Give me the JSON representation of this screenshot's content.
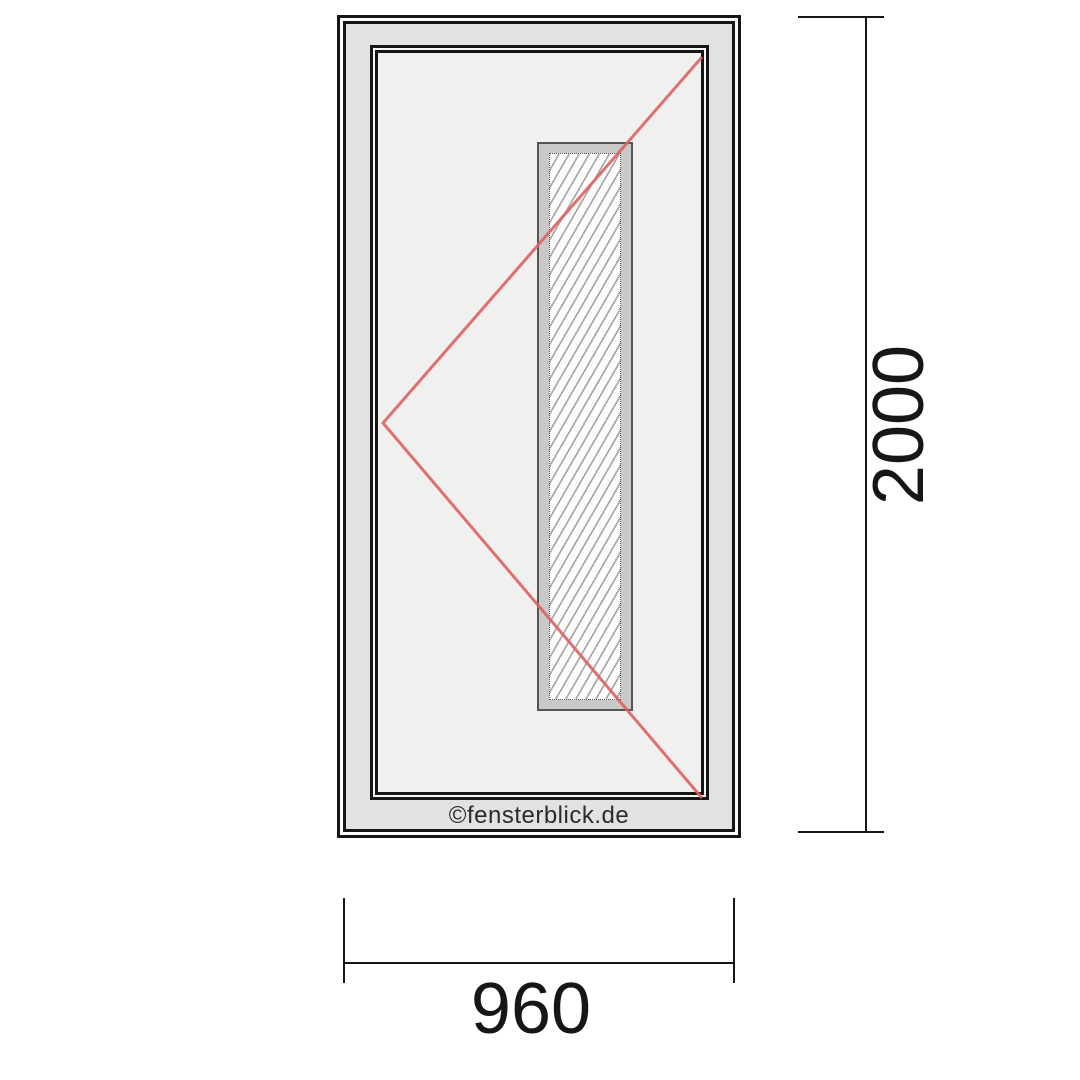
{
  "watermark": "©fensterblick.de",
  "dimensions": {
    "height_label": "2000",
    "width_label": "960"
  },
  "colors": {
    "line_black": "#161616",
    "opening_direction_red": "#de6060",
    "frame_fill": "#e2e2e1",
    "leaf_fill": "#f0f1ee",
    "glazing_frame_fill": "#c9c9c7",
    "glazing_edge": "#555555",
    "hatch_line": "#a9a9a9",
    "watermark_color": "#2b2b2b"
  }
}
